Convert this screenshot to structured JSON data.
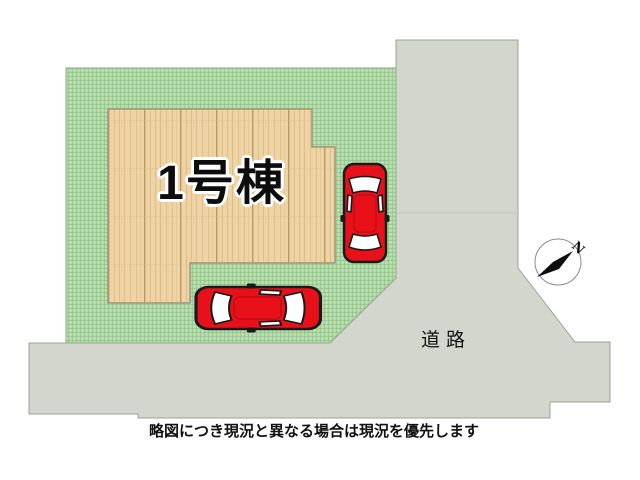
{
  "plan": {
    "building_label": "1号棟",
    "road_label": "道路",
    "caption": "略図につき現況と異なる場合は現況を優先します",
    "compass": {
      "north_label": "N"
    }
  },
  "colors": {
    "background": "#ffffff",
    "grass": "#b4dbaa",
    "grass-line": "#7fb97a",
    "wood": "#eed3a4",
    "road": "#d2d6cc",
    "road-border": "#9da196",
    "car-red": "#e8111a",
    "outline": "#1a1a1a"
  }
}
